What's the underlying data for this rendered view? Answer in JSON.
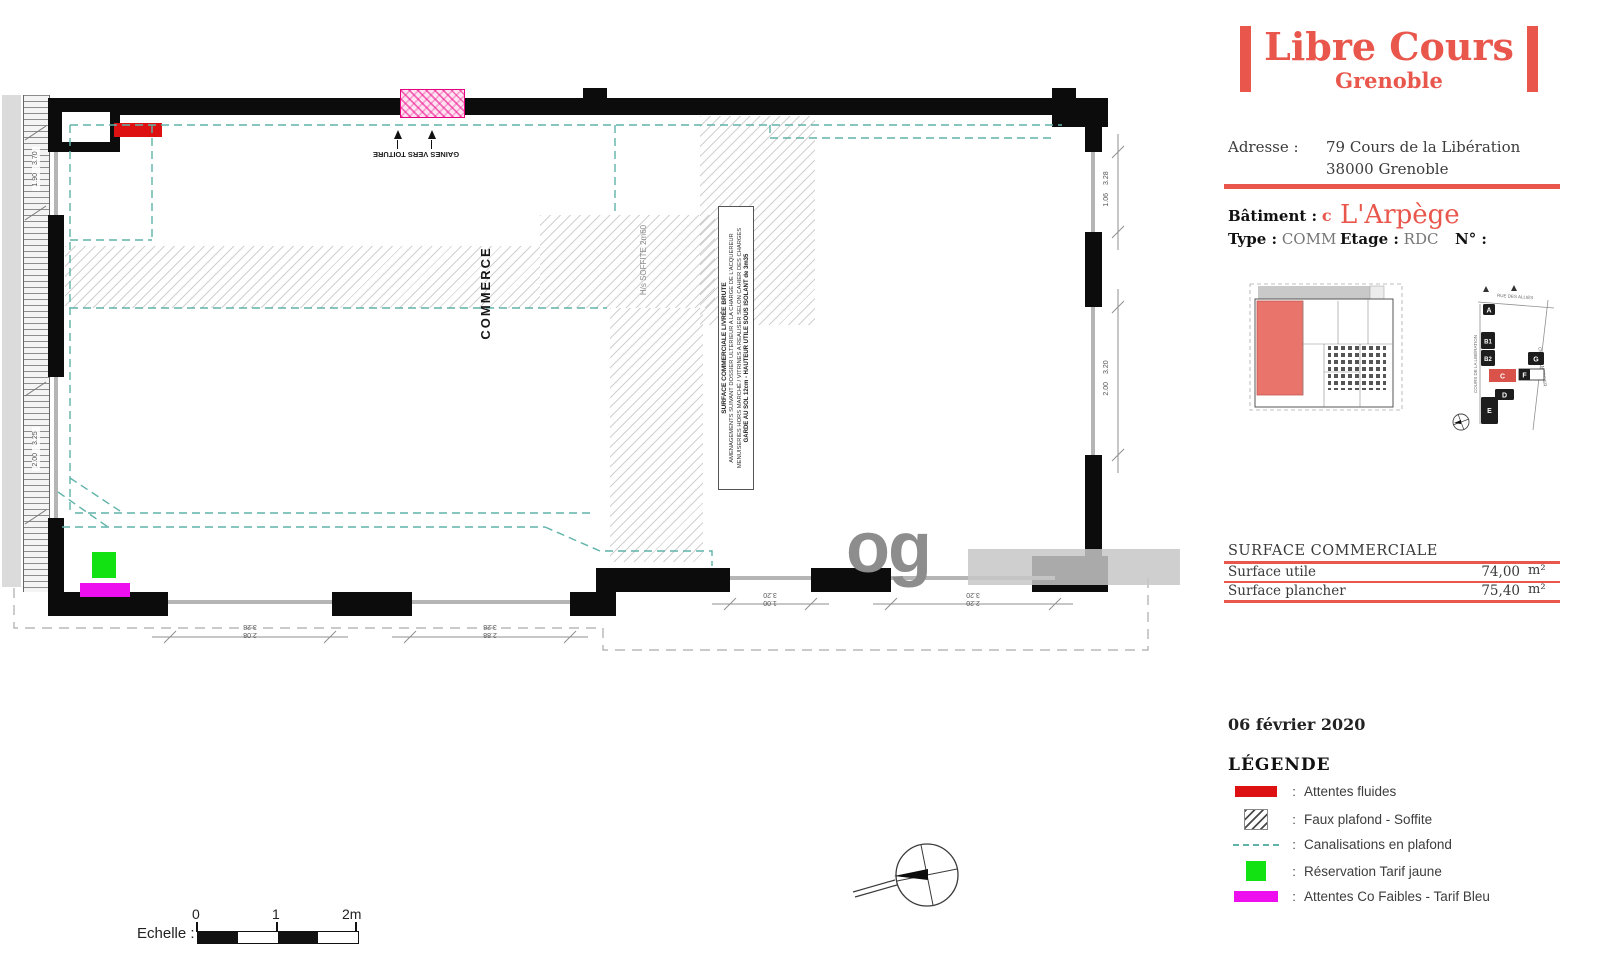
{
  "brand": {
    "title": "Libre Cours",
    "subtitle": "Grenoble"
  },
  "address": {
    "label": "Adresse :",
    "line1": "79 Cours de la Libération",
    "line2": "38000 Grenoble"
  },
  "unit": {
    "batiment_label": "Bâtiment :",
    "batiment_value": "c",
    "name": "L'Arpège",
    "type_label": "Type :",
    "type_value": "COMM",
    "etage_label": "Etage :",
    "etage_value": "RDC",
    "numero_label": "N° :"
  },
  "key_plan": {
    "street_top": "RUE DES ALLIÉS",
    "street_left": "COURS DE LA LIBÉRATION",
    "street_right": "CHEMIN MERCIER",
    "buildings": {
      "a": "A",
      "b1": "B1",
      "b2": "B2",
      "c": "C",
      "d": "D",
      "e": "E",
      "f": "F",
      "g": "G"
    }
  },
  "surface_table": {
    "title": "SURFACE COMMERCIALE",
    "rows": [
      {
        "label": "Surface utile",
        "value": "74,00",
        "unit": "m²"
      },
      {
        "label": "Surface plancher",
        "value": "75,40",
        "unit": "m²"
      }
    ]
  },
  "date": "06 février 2020",
  "legend": {
    "title": "LÉGENDE",
    "separator": ":",
    "items": [
      {
        "swatch": "red-bar",
        "label": "Attentes fluides"
      },
      {
        "swatch": "hatch-square",
        "label": "Faux plafond - Soffite"
      },
      {
        "swatch": "teal-dashed-line",
        "label": "Canalisations en plafond"
      },
      {
        "swatch": "green-square",
        "label": "Réservation Tarif jaune"
      },
      {
        "swatch": "magenta-bar",
        "label": "Attentes Co Faibles - Tarif Bleu"
      }
    ]
  },
  "scale_bar": {
    "label": "Echelle :",
    "t0": "0",
    "t1": "1",
    "t2": "2m"
  },
  "plan": {
    "room": "COMMERCE",
    "soffite": "H/s SOFFITE 2m60",
    "gaines": "GAINES VERS TOITURE",
    "note": {
      "l1": "SURFACE COMMERCIALE LIVRÉE BRUTE",
      "l2": "AMENAGEMENTS SUIVANT DOSSIER ULTERIEUR A LA CHARGE DE L'ACQUEREUR",
      "l3": "MENUISERIES HORS MARCHÉ / VITRINES A REALISER SELON CAHIER DES CHARGES",
      "l4": "GARDE AU SOL 12cm - HAUTEUR UTILE SOUS ISOLANT de 3m35"
    },
    "dims": {
      "bottom_left": [
        {
          "upper": "3.28",
          "lower": "2.08"
        },
        {
          "upper": "3.28",
          "lower": "2.88"
        }
      ],
      "bottom_right": [
        {
          "upper": "3.20",
          "lower": "1.00"
        },
        {
          "upper": "3.20",
          "lower": "2.20"
        }
      ],
      "right": [
        {
          "a": "1.06",
          "b": "3.28"
        },
        {
          "a": "2.00",
          "b": "3.20"
        }
      ],
      "left": [
        {
          "a": "1.90",
          "b": "3.70"
        },
        {
          "a": "2.00",
          "b": "3.25"
        }
      ]
    },
    "watermark": "og"
  },
  "colors": {
    "accent": "#e9564c",
    "attentes_fluides": "#dd1111",
    "canalisations": "#5fb3a9",
    "tarif_jaune": "#12e212",
    "tarif_bleu": "#ed0fed",
    "wall": "#0c0c0c"
  }
}
